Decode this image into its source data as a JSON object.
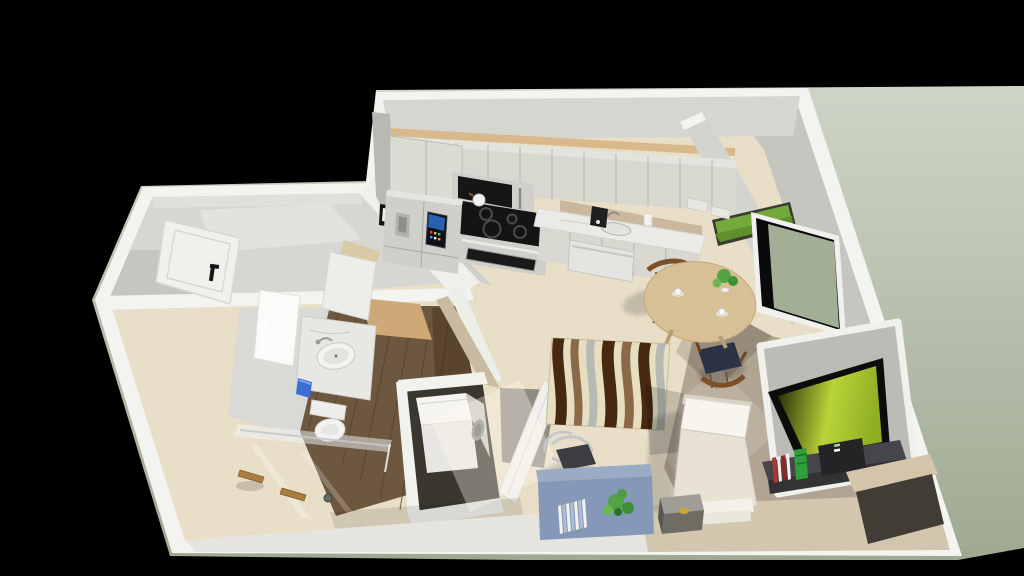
{
  "scene": {
    "type": "3d-floorplan-render",
    "view": "isometric cutaway from above",
    "rooms": [
      "entry-hall",
      "bathroom",
      "laundry-closet",
      "kitchen",
      "dining-area",
      "living-sleeping-area"
    ],
    "furniture": [
      "entry-door",
      "bathroom-door",
      "mirror",
      "bathroom-vanity",
      "sink",
      "toilet",
      "trash-bin",
      "shower-glass",
      "towel-bars",
      "floor-drain",
      "washer",
      "open-door",
      "refrigerator",
      "upper-cabinets",
      "microwave",
      "cooktop",
      "oven",
      "countertop",
      "kitchen-sink",
      "dishwasher",
      "coffee-maker",
      "wall-frame",
      "wall-art",
      "window",
      "dining-table",
      "dining-chair",
      "dining-chair",
      "table-plant",
      "area-rug",
      "bed",
      "nightstand",
      "tv",
      "tv-stand",
      "game-console",
      "books",
      "media-nook",
      "desk",
      "desk-chair",
      "desk-plant",
      "desk-books"
    ]
  },
  "palette": {
    "background": "#000000",
    "ground_light": "#ced5c6",
    "ground_dark": "#9fa992",
    "wall_white": "#f3f3f0",
    "wall_face": "#c6c6c0",
    "wall_face_dark": "#b2b2ac",
    "floor_tile": "#e9dfc8",
    "floor_tile_line": "#d9ccb2",
    "floor_carpet": "#b2a492",
    "floor_wood": "#6e573f",
    "soffit_wood": "#d9b98c",
    "cabinet": "#d8d8d0",
    "counter_marble": "#eceae6",
    "appliance_dark": "#141414",
    "stainless": "#cfcfcb",
    "fridge_screen_blue": "#2f6fd0",
    "table_wood": "#d8c096",
    "chair_wood": "#7c4f28",
    "chair_cushion": "#2c3246",
    "rug_base": "#e7ddc1",
    "rug_dark": "#46290f",
    "rug_brown": "#8a6848",
    "rug_gray": "#b7bab4",
    "bed_fabric": "#e7e2d3",
    "bed_pillow": "#f7f5ee",
    "nightstand_gray": "#6f6c66",
    "tv_black": "#0c0c0c",
    "tv_screen_dark": "#1c2306",
    "tv_screen_bright": "#b9d438",
    "tv_stand": "#46464a",
    "console_green": "#2f9e3c",
    "book_red": "#b23434",
    "media_nook_tan": "#d3c4aa",
    "desk_blue": "#8598b8",
    "plant_green": "#55a246",
    "painting_green": "#74a93c",
    "window_view_green": "#a3ae96",
    "vanity_marble": "#e9e7e3",
    "porcelain": "#f4f3f0",
    "bin_blue": "#3b6fd6",
    "towel_wood": "#a97e3f",
    "door_white": "#f1f0ed",
    "washer_white": "#f6f5f1"
  }
}
